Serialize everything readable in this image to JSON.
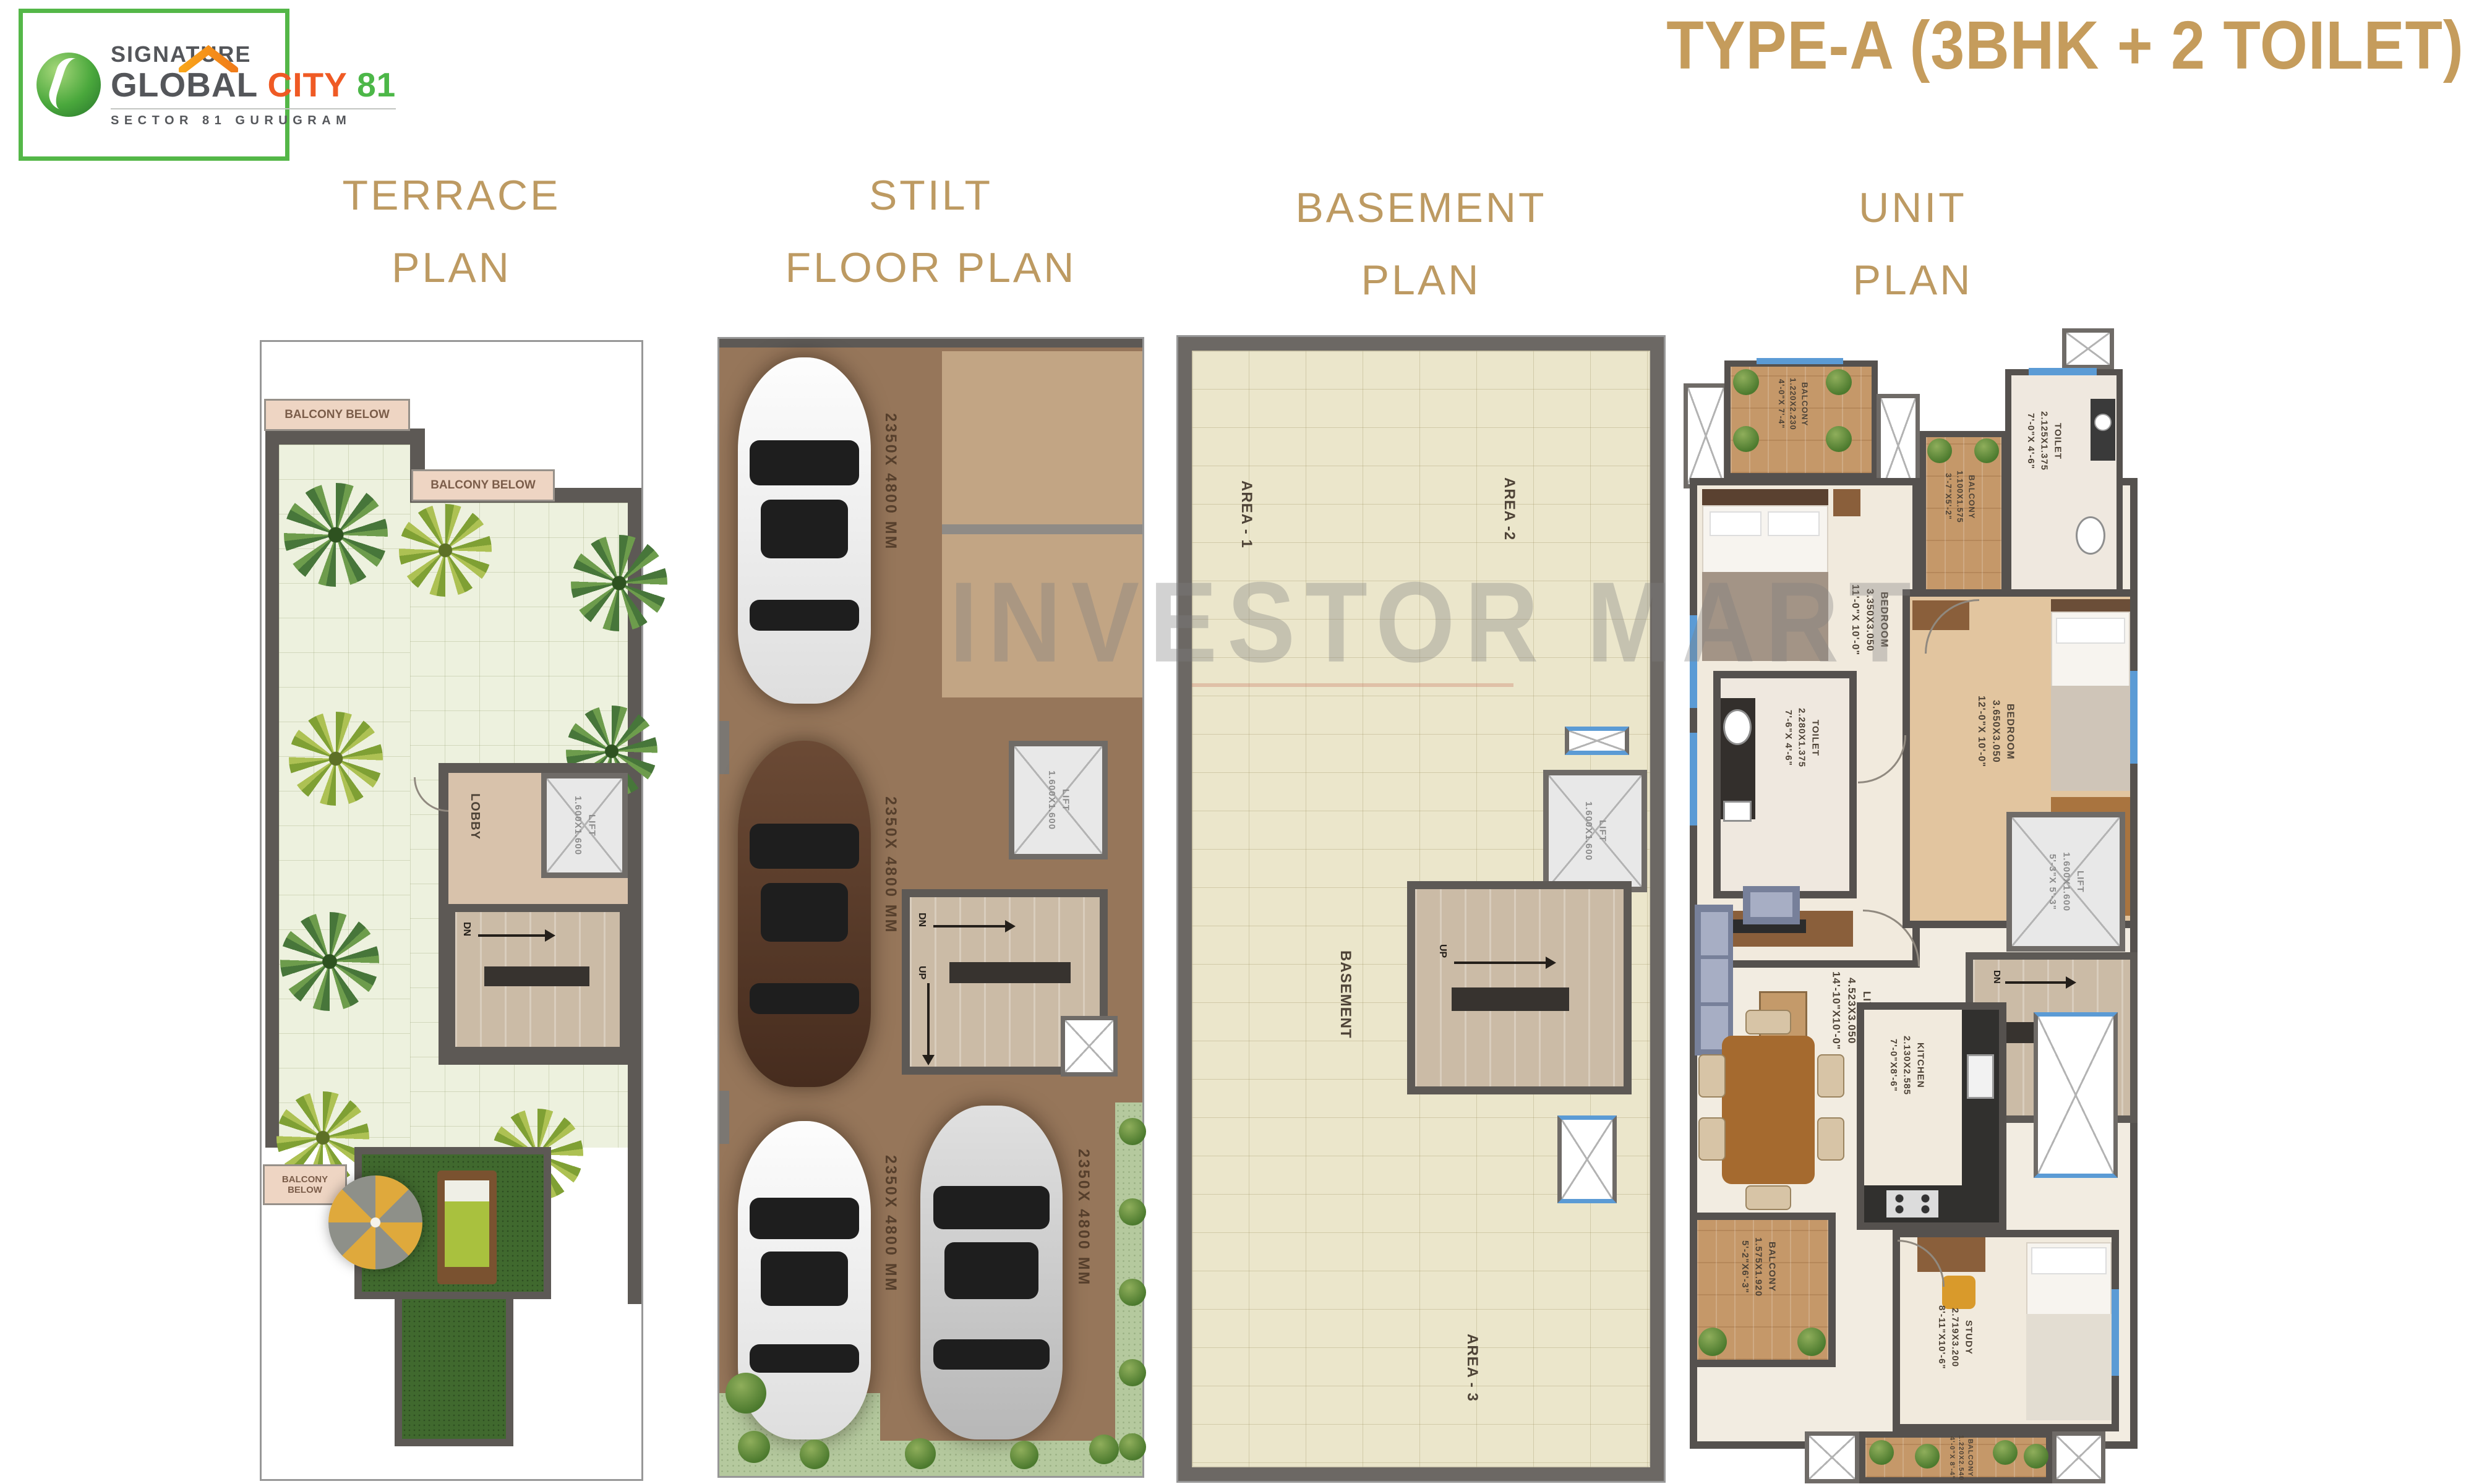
{
  "page_title": "TYPE-A (3BHK + 2 TOILET)",
  "watermark": "INVESTOR MART",
  "brand": {
    "line1": "SIGNATURE",
    "line2_a": "GLOBAL",
    "line2_b": "CITY",
    "line2_c": "81",
    "subtitle": "SECTOR 81 GURUGRAM"
  },
  "colors": {
    "gold_accent": "#bd9a62",
    "brand_green": "#54b748",
    "city_orange": "#ef5a24",
    "wall_gray": "#5d5955",
    "terrace_floor": "#edf1de",
    "basement_floor": "#ebe6cb",
    "stilt_floor": "#96765a",
    "grass_green": "#40692e",
    "balcony_wood": "#c59869",
    "window_blue": "#5b9bd5"
  },
  "terrace_plan": {
    "title_line1": "TERRACE",
    "title_line2": "PLAN",
    "labels": {
      "balcony_below_1": "BALCONY BELOW",
      "balcony_below_2": "BALCONY BELOW",
      "balcony_below_3": "BALCONY BELOW",
      "lobby": "LOBBY",
      "lift_name": "LIFT",
      "lift_dim": "1.600X1.600",
      "dn": "DN"
    }
  },
  "stilt_plan": {
    "title_line1": "STILT",
    "title_line2": "FLOOR PLAN",
    "labels": {
      "car_space_1": "2350X 4800 MM",
      "car_space_2": "2350X 4800 MM",
      "car_space_3": "2350X 4800 MM",
      "car_space_4": "2350X 4800 MM",
      "lift_name": "LIFT",
      "lift_dim": "1.600X1.600",
      "dn": "DN",
      "up": "UP"
    }
  },
  "basement_plan": {
    "title_line1": "BASEMENT",
    "title_line2": "PLAN",
    "labels": {
      "area_1": "AREA - 1",
      "area_2": "AREA -2",
      "area_3": "AREA - 3",
      "basement": "BASEMENT",
      "lift_name": "LIFT",
      "lift_dim": "1.600X1.600",
      "up": "UP"
    }
  },
  "unit_plan": {
    "title_line1": "UNIT",
    "title_line2": "PLAN",
    "dn": "DN",
    "up": "UP",
    "rooms": {
      "balcony_top": {
        "name": "BALCONY",
        "dim_m": "1.220X2.230",
        "dim_ft": "4'-0\"X 7'-4\""
      },
      "toilet_top": {
        "name": "TOILET",
        "dim_m": "2.125X1.375",
        "dim_ft": "7'-0\"X 4'-6\""
      },
      "balcony_mid": {
        "name": "BALCONY",
        "dim_m": "1.100X1.575",
        "dim_ft": "3'-7\"X5'-2\""
      },
      "bedroom_left": {
        "name": "BEDROOM",
        "dim_m": "3.350X3.050",
        "dim_ft": "11'-0\"X 10'-0\""
      },
      "bedroom_right": {
        "name": "BEDROOM",
        "dim_m": "3.650X3.050",
        "dim_ft": "12'-0\"X 10'-0\""
      },
      "toilet_mid": {
        "name": "TOILET",
        "dim_m": "2.280X1.375",
        "dim_ft": "7'-6\"X 4'-6\""
      },
      "lift": {
        "name": "LIFT",
        "dim_m": "1.600X1.600",
        "dim_ft": "5'-3\"X 5'-3\""
      },
      "living": {
        "name": "LIVING",
        "dim_m": "4.523X3.050",
        "dim_ft": "14'-10\"X10'-0\""
      },
      "kitchen": {
        "name": "KITCHEN",
        "dim_m": "2.130X2.585",
        "dim_ft": "7'-0\"X8'-6\""
      },
      "balcony_dining": {
        "name": "BALCONY",
        "dim_m": "1.575X1.920",
        "dim_ft": "5'-2\"X6'-3\""
      },
      "study": {
        "name": "STUDY",
        "dim_m": "2.719X3.200",
        "dim_ft": "8'-11\"X10'-6\""
      },
      "balcony_bottom": {
        "name": "BALCONY",
        "dim_m": "1.220X2.540",
        "dim_ft": "4'-0\"X 8'-4\""
      }
    }
  }
}
